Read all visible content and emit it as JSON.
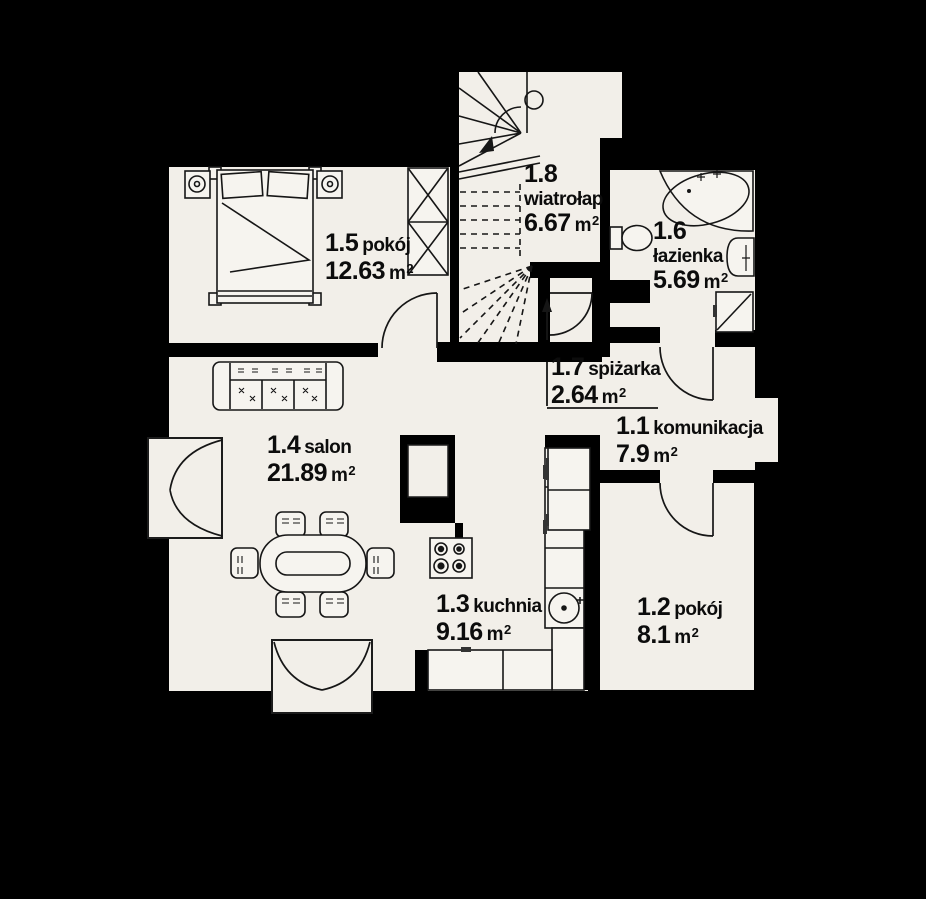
{
  "colors": {
    "background": "#000000",
    "floor": "#f2efe9",
    "line": "#161616"
  },
  "units": {
    "symbol": "m",
    "sup": "2"
  },
  "rooms": [
    {
      "id": "1.1",
      "name": "komunikacja",
      "area": "7.9"
    },
    {
      "id": "1.2",
      "name": "pokój",
      "area": "8.1"
    },
    {
      "id": "1.3",
      "name": "kuchnia",
      "area": "9.16"
    },
    {
      "id": "1.4",
      "name": "salon",
      "area": "21.89"
    },
    {
      "id": "1.5",
      "name": "pokój",
      "area": "12.63"
    },
    {
      "id": "1.6",
      "name": "łazienka",
      "area": "5.69"
    },
    {
      "id": "1.7",
      "name": "spiżarka",
      "area": "2.64"
    },
    {
      "id": "1.8",
      "name": "wiatrołap",
      "area": "6.67"
    }
  ]
}
